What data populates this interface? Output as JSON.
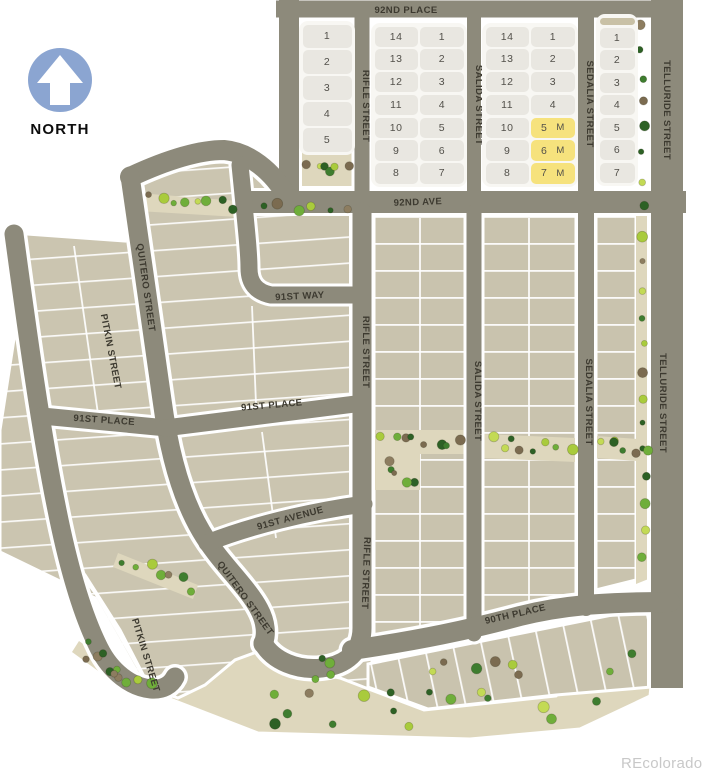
{
  "page": {
    "watermark": "REcolorado"
  },
  "north_indicator": {
    "label": "NORTH"
  },
  "colors": {
    "street": "#8d8a7b",
    "casing": "#ffffff",
    "lot": "#cbc5b0",
    "lot2": "#c9c3ae",
    "open_space": "#ded7bd",
    "cell": "#e9e7e1",
    "cell_highlight": "#f6e27d",
    "cell_tan": "#c9c1a6",
    "label": "#3d3a30",
    "north_blue": "#8ba5d1",
    "watermark": "#c8c8c8",
    "tree_palette": [
      "#2d6125",
      "#3e7d2f",
      "#6fae3a",
      "#a9cb3c",
      "#c3da55",
      "#7b6b50",
      "#8d7d60",
      "#2d6125",
      "#6fae3a"
    ]
  },
  "street_labels": [
    {
      "id": "92nd-place",
      "text": "92ND PLACE",
      "x": 406,
      "y": 13,
      "angle": 0
    },
    {
      "id": "92nd-ave",
      "text": "92ND AVE",
      "x": 418,
      "y": 205,
      "angle": -2
    },
    {
      "id": "rifle-street-north",
      "text": "RIFLE STREET",
      "x": 363,
      "y": 106,
      "angle": 90
    },
    {
      "id": "salida-street-north",
      "text": "SALIDA STREET",
      "x": 476,
      "y": 105,
      "angle": 90
    },
    {
      "id": "sedalia-street-north",
      "text": "SEDALIA STREET",
      "x": 587,
      "y": 104,
      "angle": 90
    },
    {
      "id": "telluride-street-north",
      "text": "TELLURIDE STREET",
      "x": 664,
      "y": 110,
      "angle": 90
    },
    {
      "id": "rifle-street-mid",
      "text": "RIFLE STREET",
      "x": 363,
      "y": 352,
      "angle": 90
    },
    {
      "id": "salida-street-mid",
      "text": "SALIDA STREET",
      "x": 475,
      "y": 401,
      "angle": 90
    },
    {
      "id": "sedalia-street-mid",
      "text": "SEDALIA STREET",
      "x": 586,
      "y": 402,
      "angle": 90
    },
    {
      "id": "telluride-street-mid",
      "text": "TELLURIDE STREET",
      "x": 660,
      "y": 403,
      "angle": 90
    },
    {
      "id": "rifle-street-south",
      "text": "RIFLE STREET",
      "x": 363,
      "y": 573,
      "angle": 92
    },
    {
      "id": "pitkin-street-north",
      "text": "PITKIN STREET",
      "x": 108,
      "y": 352,
      "angle": 79
    },
    {
      "id": "pitkin-street-south",
      "text": "PITKIN STREET",
      "x": 143,
      "y": 656,
      "angle": 73
    },
    {
      "id": "quitero-street-north",
      "text": "QUITERO STREET",
      "x": 143,
      "y": 288,
      "angle": 82
    },
    {
      "id": "quitero-street-south",
      "text": "QUITERO STREET",
      "x": 243,
      "y": 600,
      "angle": 54
    },
    {
      "id": "91st-way",
      "text": "91ST WAY",
      "x": 300,
      "y": 299,
      "angle": -3
    },
    {
      "id": "91st-place-west",
      "text": "91ST PLACE",
      "x": 104,
      "y": 423,
      "angle": 4
    },
    {
      "id": "91st-place-east",
      "text": "91ST PLACE",
      "x": 272,
      "y": 408,
      "angle": -5
    },
    {
      "id": "91st-avenue",
      "text": "91ST AVENUE",
      "x": 291,
      "y": 521,
      "angle": -15
    },
    {
      "id": "90th-place",
      "text": "90TH PLACE",
      "x": 516,
      "y": 617,
      "angle": -13
    }
  ],
  "lot_blocks": [
    {
      "id": "a",
      "x": 299,
      "y": 21,
      "w": 56,
      "h": 134,
      "cols": 1,
      "cells": [
        "1",
        "2",
        "3",
        "4",
        "5"
      ]
    },
    {
      "id": "b",
      "x": 371,
      "y": 23,
      "w": 96,
      "h": 164,
      "cols": 2,
      "cells": [
        "14",
        "1",
        "13",
        "2",
        "12",
        "3",
        "11",
        "4",
        "10",
        "5",
        "9",
        "6",
        "8",
        "7"
      ]
    },
    {
      "id": "c",
      "x": 482,
      "y": 23,
      "w": 96,
      "h": 164,
      "cols": 2,
      "cells": [
        "14",
        "1",
        "13",
        "2",
        "12",
        "3",
        "11",
        "4",
        "10",
        {
          "t": "5",
          "suffix": "M",
          "hl": true
        },
        "9",
        {
          "t": "6",
          "suffix": "M",
          "hl": true
        },
        "8",
        {
          "t": "7",
          "suffix": "M",
          "hl": true
        }
      ]
    },
    {
      "id": "d",
      "x": 596,
      "y": 14,
      "w": 42,
      "h": 172,
      "cols": 1,
      "cells": [
        {
          "t": "",
          "tan": true
        },
        "1",
        "2",
        "3",
        "4",
        "5",
        "6",
        "7"
      ]
    }
  ],
  "vegetation": {
    "strips": [
      {
        "x1": 306,
        "y1": 164,
        "x2": 348,
        "y2": 172,
        "n": 6,
        "j": 8
      },
      {
        "x1": 641,
        "y1": 22,
        "x2": 645,
        "y2": 556,
        "n": 21,
        "j": 4
      },
      {
        "x1": 146,
        "y1": 199,
        "x2": 232,
        "y2": 207,
        "n": 8,
        "j": 6
      },
      {
        "x1": 264,
        "y1": 206,
        "x2": 348,
        "y2": 211,
        "n": 6,
        "j": 4
      },
      {
        "x1": 381,
        "y1": 438,
        "x2": 462,
        "y2": 444,
        "n": 8,
        "j": 5
      },
      {
        "x1": 386,
        "y1": 460,
        "x2": 414,
        "y2": 482,
        "n": 5,
        "j": 8
      },
      {
        "x1": 488,
        "y1": 441,
        "x2": 572,
        "y2": 450,
        "n": 8,
        "j": 6
      },
      {
        "x1": 600,
        "y1": 441,
        "x2": 646,
        "y2": 452,
        "n": 6,
        "j": 6
      },
      {
        "x1": 124,
        "y1": 560,
        "x2": 192,
        "y2": 588,
        "n": 7,
        "j": 7
      },
      {
        "x1": 85,
        "y1": 647,
        "x2": 124,
        "y2": 677,
        "n": 6,
        "j": 7
      }
    ],
    "patches": [
      {
        "x": 250,
        "y": 692,
        "w": 380,
        "h": 38,
        "n": 16
      },
      {
        "x": 430,
        "y": 638,
        "w": 210,
        "h": 38,
        "n": 8
      },
      {
        "x": 92,
        "y": 652,
        "w": 115,
        "h": 50,
        "n": 5
      },
      {
        "x": 300,
        "y": 658,
        "w": 95,
        "h": 32,
        "n": 4
      }
    ]
  }
}
